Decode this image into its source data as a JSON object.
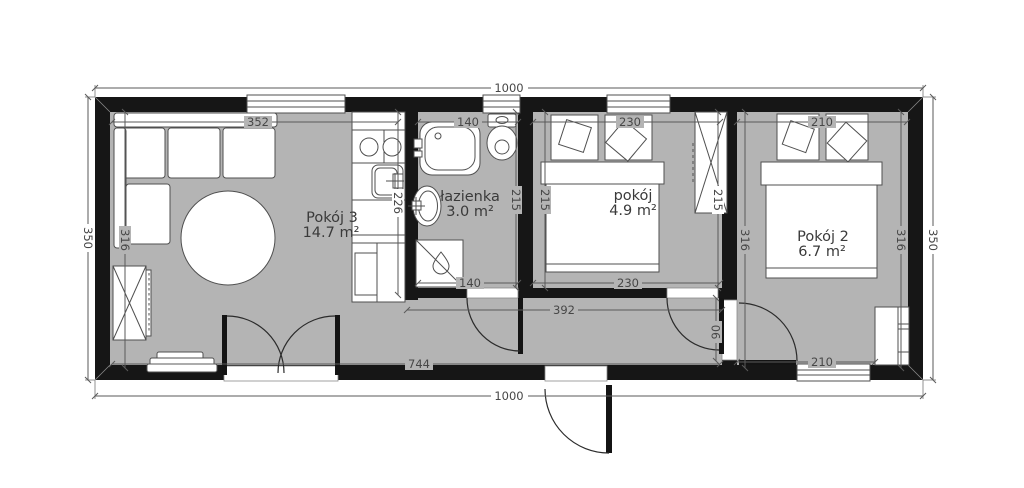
{
  "plan": {
    "colors": {
      "wall": "#161616",
      "floor": "#b4b4b4",
      "furniture_outline": "#4f4f4f",
      "dimension_text": "#474747"
    },
    "rooms": [
      {
        "name": "Pokój 3",
        "area": "14.7 m²"
      },
      {
        "name": "łazienka",
        "area": "3.0 m²"
      },
      {
        "name": "pokój",
        "area": "4.9 m²"
      },
      {
        "name": "Pokój 2",
        "area": "6.7 m²"
      }
    ],
    "dimensions": {
      "overall_width_top": "1000",
      "overall_width_bottom": "1000",
      "overall_height_left": "350",
      "overall_height_right": "350",
      "living_window_top": "352",
      "living_height": "316",
      "kitchen_length": "226",
      "bath_top": "140",
      "bath_bottom": "140",
      "bath_height": "215",
      "bedroom1_top": "230",
      "bedroom1_bottom": "230",
      "bedroom1_height": "215",
      "wardrobe_height": "215",
      "bedroom2_top": "210",
      "bedroom2_bottom": "210",
      "bedroom2_height_left": "316",
      "bedroom2_height_right": "316",
      "hall_width": "392",
      "hall_length": "744",
      "door_opening": "90"
    },
    "furniture_icons": [
      "corner-sofa",
      "round-table",
      "wardrobe",
      "shoe-bench",
      "kitchen-counter",
      "hob",
      "kitchen-sink",
      "bathtub",
      "toilet",
      "washbasin",
      "shower",
      "double-bed",
      "double-bed",
      "wardrobe",
      "dresser"
    ]
  }
}
